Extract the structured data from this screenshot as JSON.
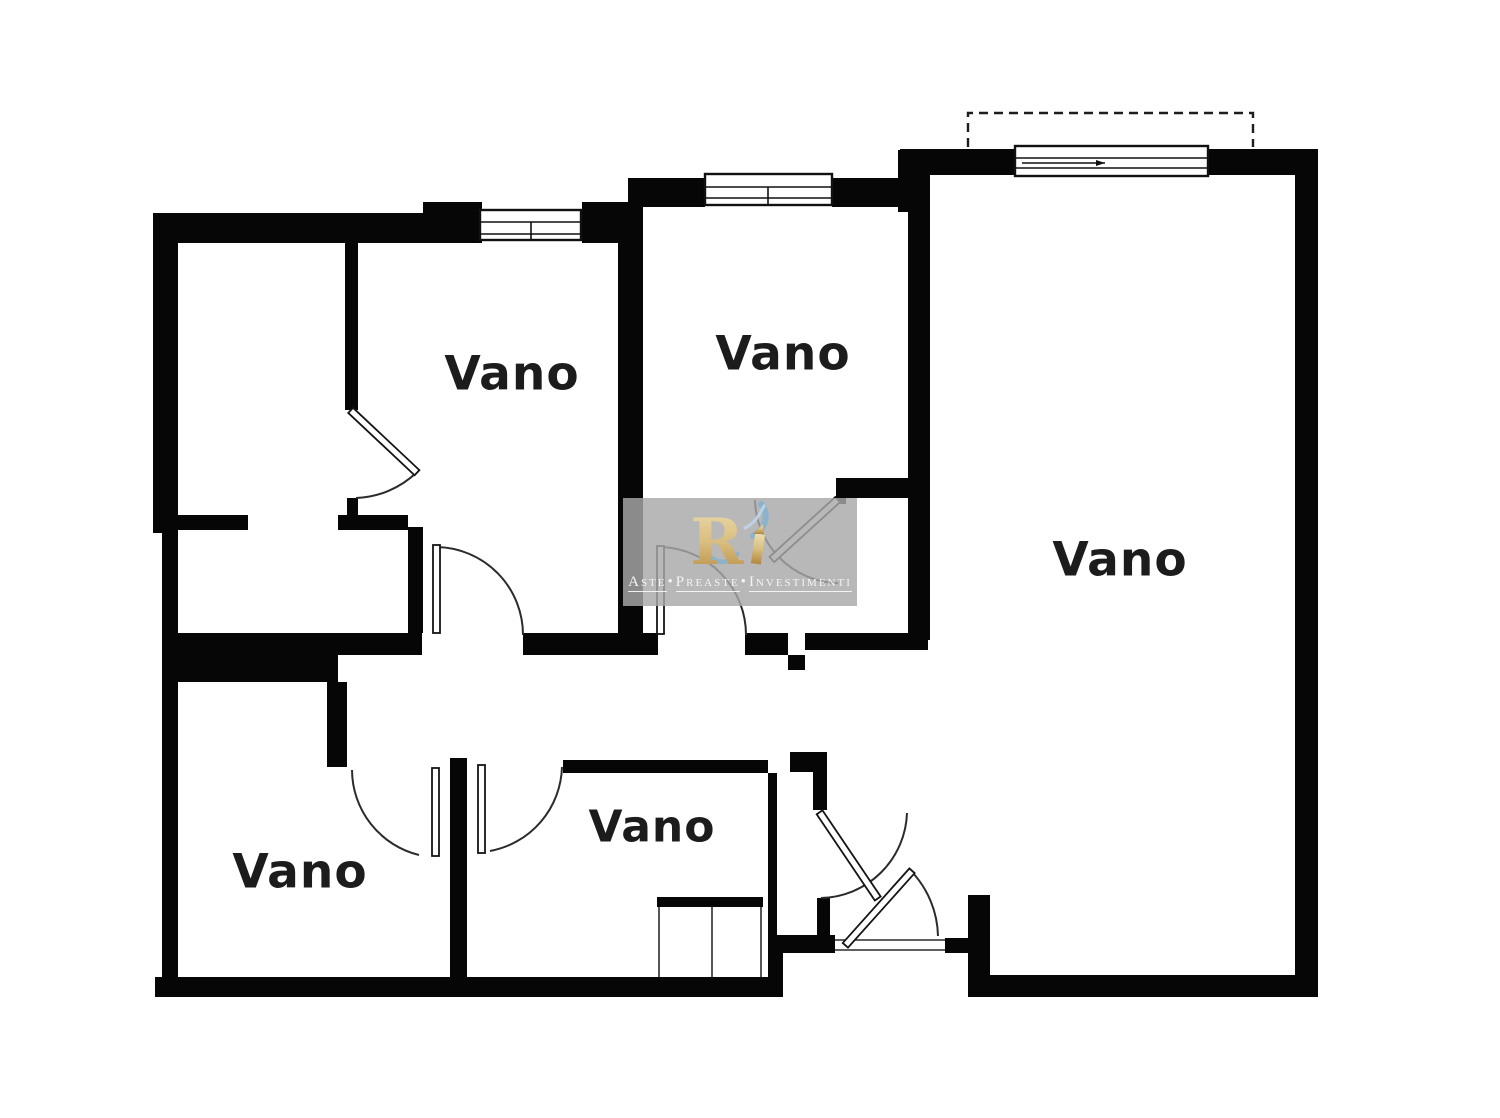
{
  "colors": {
    "wall": "#060606",
    "arc": "#2b2b2b",
    "label": "#1c1c1c",
    "bg": "#ffffff",
    "watermark_bg": "#a8a8a8",
    "watermark_text": "#f4f4f4",
    "logo_gold": "#c9a254",
    "logo_gold_light": "#e9d7a4",
    "logo_blue": "#85b0cf"
  },
  "rooms": [
    {
      "label": "Vano"
    },
    {
      "label": "Vano"
    },
    {
      "label": "Vano"
    },
    {
      "label": "Vano"
    },
    {
      "label": "Vano"
    }
  ],
  "watermark": {
    "logo_letter": "R",
    "words": [
      "Aste",
      "Preaste",
      "Investimenti"
    ],
    "separator": "•"
  }
}
